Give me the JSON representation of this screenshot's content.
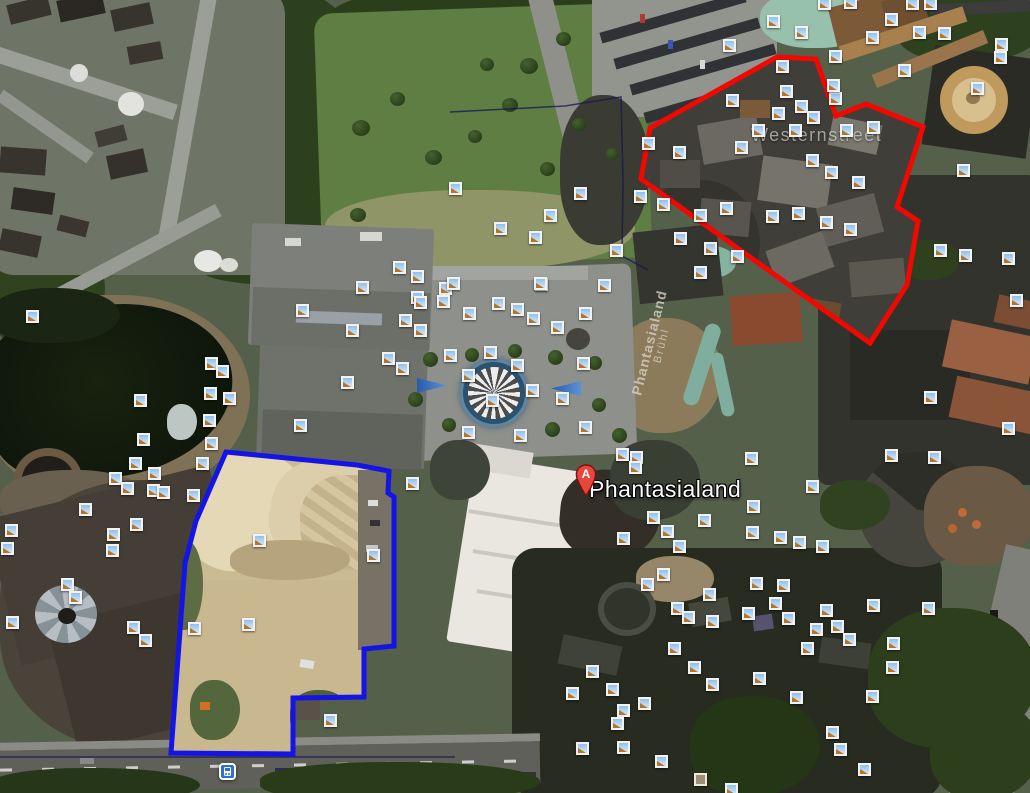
{
  "map": {
    "place_label": {
      "text": "Phantasialand",
      "pin_letter": "A",
      "pin_x": 575,
      "pin_y": 464,
      "text_x": 589,
      "text_y": 476
    },
    "street_label": {
      "text": "Westernstreet",
      "x": 751,
      "y": 125
    },
    "roof_label": {
      "line1": "Phantasialand",
      "line2": "Brühl",
      "x": 655,
      "y": 344,
      "rotation_deg": -76
    },
    "overlays": {
      "red_polygon": {
        "name": "construction-area-north",
        "color": "#f20800",
        "stroke_width": 5,
        "points": [
          [
            777,
            57
          ],
          [
            816,
            59
          ],
          [
            836,
            116
          ],
          [
            866,
            104
          ],
          [
            923,
            127
          ],
          [
            897,
            207
          ],
          [
            918,
            221
          ],
          [
            907,
            285
          ],
          [
            870,
            343
          ],
          [
            641,
            179
          ],
          [
            650,
            128
          ]
        ]
      },
      "blue_polygon": {
        "name": "construction-area-south",
        "color": "#1414e6",
        "stroke_width": 5,
        "points": [
          [
            226,
            452
          ],
          [
            357,
            465
          ],
          [
            389,
            471
          ],
          [
            388,
            493
          ],
          [
            394,
            497
          ],
          [
            394,
            646
          ],
          [
            364,
            649
          ],
          [
            364,
            697
          ],
          [
            293,
            698
          ],
          [
            293,
            754
          ],
          [
            171,
            753
          ],
          [
            185,
            563
          ],
          [
            196,
            521
          ]
        ]
      },
      "boundary_lines": {
        "color": "rgba(22,22,85,0.75)",
        "stroke_width": 1.5,
        "polylines": [
          [
            [
              450,
              112
            ],
            [
              565,
              106
            ],
            [
              621,
              97
            ],
            [
              623,
              180
            ],
            [
              622,
              256
            ],
            [
              648,
              270
            ]
          ],
          [
            [
              0,
              757
            ],
            [
              455,
              757
            ]
          ]
        ]
      }
    },
    "transit_icon": {
      "x": 227,
      "y": 771
    },
    "square_icon": {
      "x": 700,
      "y": 779
    },
    "photo_icons": [
      [
        773,
        21
      ],
      [
        801,
        32
      ],
      [
        824,
        3
      ],
      [
        850,
        2
      ],
      [
        891,
        19
      ],
      [
        872,
        37
      ],
      [
        912,
        3
      ],
      [
        930,
        3
      ],
      [
        919,
        32
      ],
      [
        944,
        33
      ],
      [
        1001,
        44
      ],
      [
        1000,
        57
      ],
      [
        835,
        56
      ],
      [
        904,
        70
      ],
      [
        729,
        45
      ],
      [
        782,
        66
      ],
      [
        786,
        91
      ],
      [
        835,
        98
      ],
      [
        833,
        85
      ],
      [
        977,
        88
      ],
      [
        801,
        106
      ],
      [
        648,
        143
      ],
      [
        679,
        152
      ],
      [
        732,
        100
      ],
      [
        741,
        147
      ],
      [
        758,
        130
      ],
      [
        778,
        113
      ],
      [
        795,
        130
      ],
      [
        813,
        117
      ],
      [
        846,
        130
      ],
      [
        873,
        127
      ],
      [
        640,
        196
      ],
      [
        663,
        204
      ],
      [
        700,
        215
      ],
      [
        726,
        208
      ],
      [
        772,
        216
      ],
      [
        798,
        213
      ],
      [
        826,
        222
      ],
      [
        850,
        229
      ],
      [
        812,
        160
      ],
      [
        831,
        172
      ],
      [
        858,
        182
      ],
      [
        680,
        238
      ],
      [
        710,
        248
      ],
      [
        737,
        256
      ],
      [
        700,
        272
      ],
      [
        963,
        170
      ],
      [
        940,
        250
      ],
      [
        965,
        255
      ],
      [
        1008,
        258
      ],
      [
        1016,
        300
      ],
      [
        455,
        188
      ],
      [
        580,
        193
      ],
      [
        550,
        215
      ],
      [
        500,
        228
      ],
      [
        535,
        237
      ],
      [
        616,
        250
      ],
      [
        399,
        267
      ],
      [
        417,
        276
      ],
      [
        362,
        287
      ],
      [
        445,
        288
      ],
      [
        541,
        284
      ],
      [
        604,
        285
      ],
      [
        417,
        297
      ],
      [
        302,
        310
      ],
      [
        352,
        330
      ],
      [
        347,
        382
      ],
      [
        300,
        425
      ],
      [
        420,
        302
      ],
      [
        443,
        301
      ],
      [
        469,
        313
      ],
      [
        498,
        303
      ],
      [
        517,
        309
      ],
      [
        533,
        318
      ],
      [
        557,
        327
      ],
      [
        585,
        313
      ],
      [
        540,
        283
      ],
      [
        453,
        283
      ],
      [
        405,
        320
      ],
      [
        420,
        330
      ],
      [
        388,
        358
      ],
      [
        402,
        368
      ],
      [
        450,
        355
      ],
      [
        468,
        375
      ],
      [
        490,
        352
      ],
      [
        492,
        400
      ],
      [
        517,
        365
      ],
      [
        532,
        390
      ],
      [
        562,
        398
      ],
      [
        583,
        363
      ],
      [
        585,
        427
      ],
      [
        520,
        435
      ],
      [
        468,
        432
      ],
      [
        32,
        316
      ],
      [
        140,
        400
      ],
      [
        143,
        439
      ],
      [
        154,
        473
      ],
      [
        135,
        463
      ],
      [
        115,
        478
      ],
      [
        127,
        488
      ],
      [
        153,
        490
      ],
      [
        211,
        363
      ],
      [
        222,
        371
      ],
      [
        210,
        393
      ],
      [
        229,
        398
      ],
      [
        209,
        420
      ],
      [
        211,
        443
      ],
      [
        202,
        463
      ],
      [
        163,
        492
      ],
      [
        193,
        495
      ],
      [
        11,
        530
      ],
      [
        7,
        548
      ],
      [
        12,
        622
      ],
      [
        85,
        509
      ],
      [
        113,
        534
      ],
      [
        136,
        524
      ],
      [
        112,
        550
      ],
      [
        67,
        584
      ],
      [
        75,
        597
      ],
      [
        133,
        627
      ],
      [
        145,
        640
      ],
      [
        194,
        628
      ],
      [
        248,
        624
      ],
      [
        259,
        540
      ],
      [
        373,
        555
      ],
      [
        412,
        483
      ],
      [
        330,
        720
      ],
      [
        622,
        454
      ],
      [
        636,
        457
      ],
      [
        635,
        467
      ],
      [
        751,
        458
      ],
      [
        812,
        486
      ],
      [
        753,
        506
      ],
      [
        704,
        520
      ],
      [
        653,
        517
      ],
      [
        623,
        538
      ],
      [
        667,
        531
      ],
      [
        679,
        546
      ],
      [
        752,
        532
      ],
      [
        780,
        537
      ],
      [
        799,
        542
      ],
      [
        663,
        574
      ],
      [
        647,
        584
      ],
      [
        709,
        594
      ],
      [
        677,
        608
      ],
      [
        688,
        617
      ],
      [
        712,
        621
      ],
      [
        756,
        583
      ],
      [
        783,
        585
      ],
      [
        775,
        603
      ],
      [
        748,
        613
      ],
      [
        788,
        618
      ],
      [
        826,
        610
      ],
      [
        816,
        629
      ],
      [
        837,
        626
      ],
      [
        849,
        639
      ],
      [
        807,
        648
      ],
      [
        674,
        648
      ],
      [
        694,
        667
      ],
      [
        712,
        684
      ],
      [
        592,
        671
      ],
      [
        572,
        693
      ],
      [
        612,
        689
      ],
      [
        644,
        703
      ],
      [
        623,
        710
      ],
      [
        617,
        723
      ],
      [
        582,
        748
      ],
      [
        623,
        747
      ],
      [
        661,
        761
      ],
      [
        731,
        789
      ],
      [
        759,
        678
      ],
      [
        796,
        697
      ],
      [
        832,
        732
      ],
      [
        840,
        749
      ],
      [
        864,
        769
      ],
      [
        872,
        696
      ],
      [
        892,
        667
      ],
      [
        893,
        643
      ],
      [
        873,
        605
      ],
      [
        928,
        608
      ],
      [
        930,
        397
      ],
      [
        1008,
        428
      ],
      [
        891,
        455
      ],
      [
        934,
        457
      ],
      [
        822,
        546
      ]
    ]
  }
}
